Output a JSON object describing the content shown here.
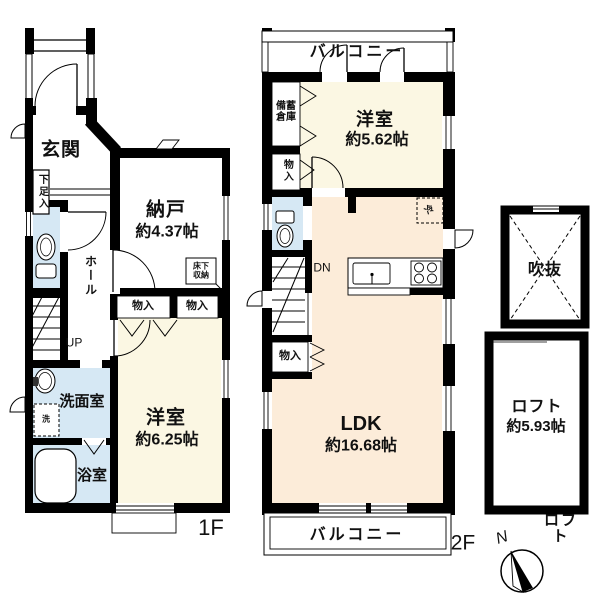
{
  "colors": {
    "wall": "#000000",
    "wet_room": "#d6e8f4",
    "bedroom": "#fbf7e3",
    "ldk": "#fcecd9",
    "background": "#ffffff"
  },
  "floor1": {
    "floor_label": "1F",
    "entrance": "玄関",
    "shoe_cabinet": "下足入",
    "storage_room": "納戸",
    "storage_room_size": "約4.37帖",
    "underfloor_storage": "床下\n収納",
    "hall": "ホール",
    "stairs_up": "UP",
    "closet_left": "物入",
    "closet_right": "物入",
    "washroom": "洗面室",
    "washer_symbol": "洗",
    "bathroom": "浴室",
    "bedroom": "洋室",
    "bedroom_size": "約6.25帖"
  },
  "floor2": {
    "floor_label": "2F",
    "balcony_top": "バルコニー",
    "balcony_bottom": "バルコニー",
    "bedroom": "洋室",
    "bedroom_size": "約5.62帖",
    "stock_storage": "備蓄\n倉庫",
    "closet_upper": "物入",
    "stairs_down": "DN",
    "closet_lower": "物入",
    "ldk": "LDK",
    "ldk_size": "約16.68帖",
    "fridge_symbol": "冷"
  },
  "loft": {
    "void": "吹抜",
    "name": "ロフト",
    "size": "約5.93帖",
    "caption": "ロフト"
  },
  "compass": {
    "north": "N"
  }
}
